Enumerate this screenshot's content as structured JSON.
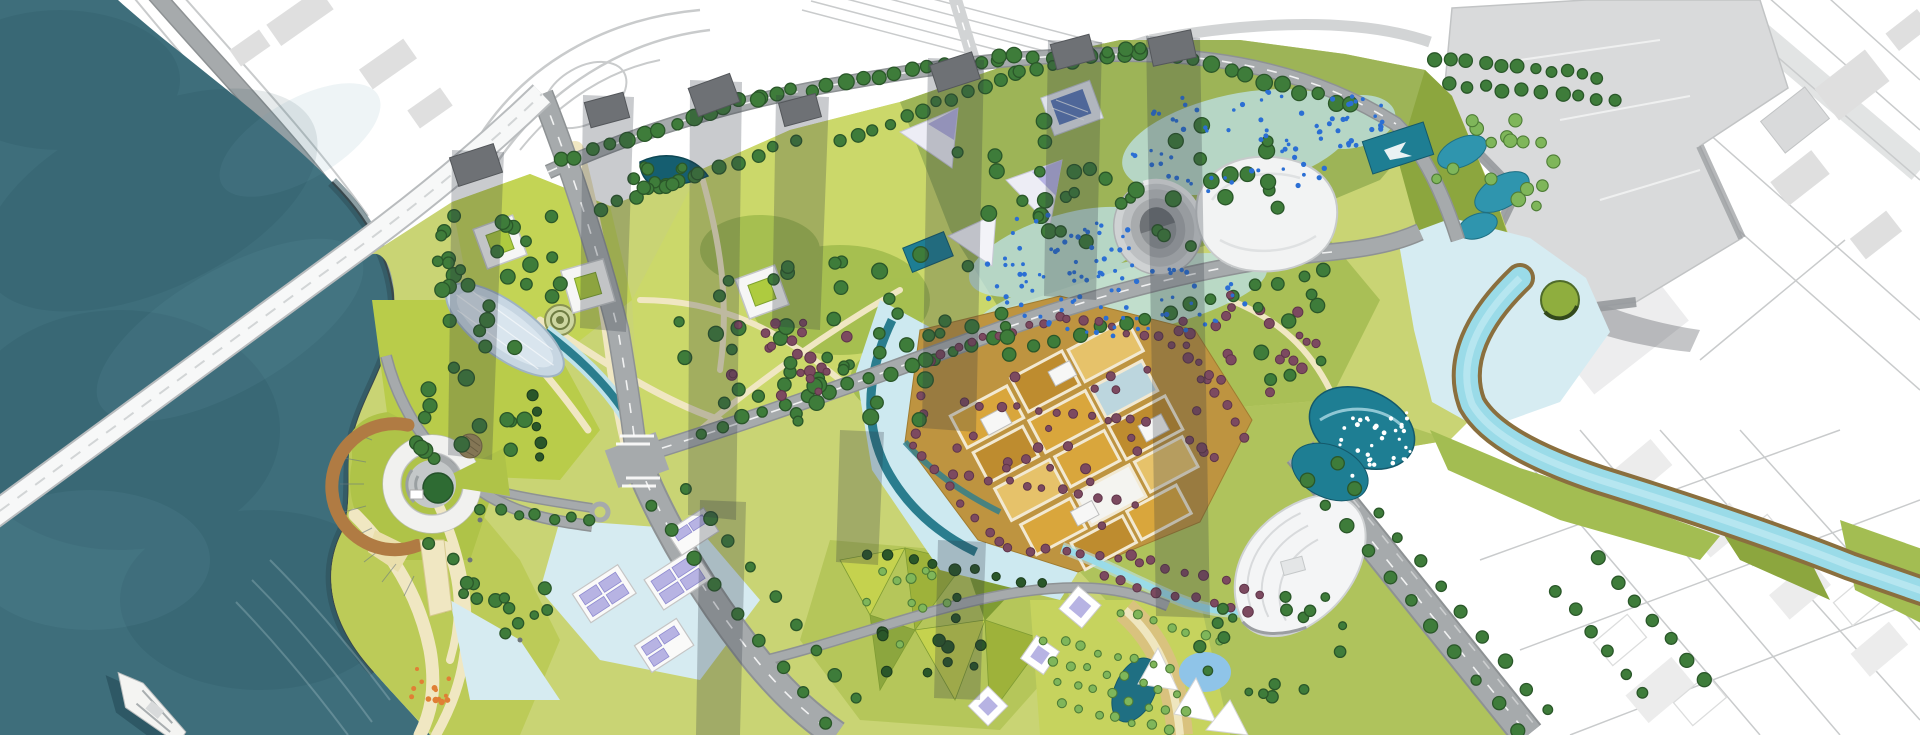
{
  "meta": {
    "title": "aerial-masterplan-rendering",
    "description": "top-down rendered urban waterfront masterplan with teal bay, bridge, parks, golden district, winding river and white line-work city context",
    "canvas": {
      "width": 1920,
      "height": 735
    }
  },
  "palette": {
    "water": "#3E6E7B",
    "waterDeep": "#2E4F58",
    "seawall": "#39484D",
    "contextLine": "#C9CBCC",
    "contextBlob": "#DFDFDF",
    "buildingGray": "#D9DADB",
    "buildingShade": "#96999C",
    "towerGray": "#6E7175",
    "roadGray": "#A6AAAC",
    "roadCase": "#8E9294",
    "bridgeWhite": "#F7F8F8",
    "lawnBright": "#C3D455",
    "lawnMid": "#9DB94A",
    "lawnOlive": "#8CA63E",
    "treeGreen": "#3E7C3A",
    "treeDark": "#2A5729",
    "treeMint": "#7FB65A",
    "maroon": "#7C4A60",
    "maroonDark": "#5F3549",
    "gold": "#D9A63C",
    "goldDark": "#BE8C2F",
    "goldPale": "#E6C26A",
    "lavender": "#B7B3E3",
    "lavenderDark": "#8F8BD0",
    "aqua": "#9ADBE8",
    "aquaPale": "#CDE9F0",
    "tealPond": "#1E7E93",
    "tealDark": "#155E70",
    "sand": "#EADFAC",
    "pathBeige": "#F0E7C2",
    "bankBrown": "#8A6F3E",
    "pierBrown": "#B07B43",
    "orange": "#E07F35",
    "speckBlue": "#2B6FD4",
    "shadowBand": "#2E3540"
  },
  "landmarks": {
    "bay": "tidal-bay-water",
    "bridge": "cable-bridge",
    "boat": "cruise-boat",
    "pier": "circular-ferry-pier",
    "dome": "glasshouse-dome",
    "stadium": "oval-amphitheatre",
    "hall": "exhibition-hall",
    "golden": "golden-courtyard-district",
    "fountains": "twin-fountain-pools",
    "river": "meandering-river-corridor",
    "hq": "headquarters-complex",
    "solar": "solar-roof-buildings",
    "orchard": "orchard-grove",
    "sails": "shade-sail-pavilions",
    "shadows": "tower-shadow-bands"
  },
  "vegetation": {
    "rows": [
      [
        560,
        162,
        758,
        97,
        13,
        7,
        "g"
      ],
      [
        758,
        97,
        998,
        58,
        15,
        7,
        "g"
      ],
      [
        998,
        58,
        1178,
        54,
        11,
        7,
        "g"
      ],
      [
        1178,
        54,
        1352,
        106,
        11,
        7,
        "g"
      ],
      [
        600,
        208,
        795,
        142,
        11,
        6,
        "g"
      ],
      [
        700,
        432,
        995,
        338,
        15,
        6,
        "g"
      ],
      [
        1012,
        352,
        1325,
        270,
        15,
        6,
        "g"
      ],
      [
        726,
        406,
        1000,
        315,
        10,
        6,
        "g"
      ],
      [
        652,
        505,
        826,
        722,
        9,
        6,
        "g"
      ],
      [
        688,
        492,
        858,
        700,
        9,
        6,
        "g"
      ],
      [
        1306,
        478,
        1518,
        728,
        11,
        6,
        "g"
      ],
      [
        1336,
        462,
        1546,
        712,
        11,
        6,
        "g"
      ],
      [
        1558,
        592,
        1642,
        692,
        6,
        6,
        "g"
      ],
      [
        1600,
        560,
        1706,
        682,
        7,
        6,
        "g"
      ],
      [
        482,
        508,
        592,
        522,
        7,
        5,
        "g"
      ],
      [
        533,
        396,
        541,
        458,
        5,
        5,
        "d"
      ],
      [
        1436,
        57,
        1598,
        76,
        11,
        6,
        "g"
      ],
      [
        1448,
        84,
        1618,
        102,
        10,
        6,
        "g"
      ],
      [
        842,
        142,
        1018,
        72,
        12,
        6,
        "g"
      ],
      [
        1020,
        70,
        1140,
        46,
        8,
        6,
        "g"
      ],
      [
        1102,
        576,
        1248,
        614,
        9,
        4.5,
        "m"
      ],
      [
        1130,
        556,
        1262,
        592,
        8,
        4.5,
        "m"
      ],
      [
        942,
        352,
        1058,
        318,
        9,
        4,
        "m"
      ],
      [
        1068,
        316,
        1188,
        346,
        9,
        4,
        "m"
      ],
      [
        1198,
        362,
        1242,
        438,
        6,
        4,
        "m"
      ],
      [
        928,
        362,
        916,
        448,
        6,
        4,
        "m"
      ],
      [
        920,
        458,
        1002,
        544,
        7,
        4,
        "m"
      ],
      [
        1010,
        548,
        1138,
        560,
        8,
        4,
        "m"
      ],
      [
        962,
        402,
        1148,
        422,
        11,
        4,
        "m"
      ],
      [
        952,
        472,
        1118,
        500,
        10,
        4,
        "m"
      ],
      [
        430,
        542,
        520,
        622,
        5,
        6,
        "g"
      ],
      [
        1046,
        638,
        1172,
        670,
        8,
        4,
        "t"
      ],
      [
        1052,
        660,
        1178,
        692,
        8,
        4,
        "t"
      ],
      [
        1058,
        682,
        1184,
        714,
        8,
        4,
        "t"
      ],
      [
        1064,
        704,
        1168,
        732,
        7,
        4,
        "t"
      ],
      [
        1118,
        612,
        1222,
        640,
        7,
        4,
        "t"
      ],
      [
        868,
        552,
        1042,
        584,
        9,
        5,
        "d"
      ]
    ],
    "clusters": [
      [
        508,
        262,
        82,
        62,
        24,
        6.5,
        "g"
      ],
      [
        468,
        392,
        70,
        78,
        20,
        6.5,
        "g"
      ],
      [
        846,
        332,
        168,
        100,
        42,
        6.5,
        "g"
      ],
      [
        792,
        352,
        72,
        44,
        20,
        4.5,
        "m"
      ],
      [
        1118,
        182,
        180,
        75,
        38,
        6.5,
        "g"
      ],
      [
        1246,
        344,
        72,
        52,
        24,
        4.5,
        "m"
      ],
      [
        1258,
        332,
        80,
        56,
        8,
        6,
        "g"
      ],
      [
        1494,
        166,
        62,
        55,
        16,
        6,
        "t"
      ],
      [
        1282,
        640,
        88,
        58,
        18,
        5,
        "g"
      ],
      [
        1086,
        442,
        135,
        85,
        26,
        4,
        "m"
      ],
      [
        948,
        640,
        75,
        55,
        12,
        5,
        "d"
      ],
      [
        516,
        600,
        55,
        45,
        9,
        5.5,
        "g"
      ],
      [
        425,
        688,
        26,
        24,
        13,
        2.6,
        "o"
      ],
      [
        1238,
        142,
        115,
        52,
        55,
        2.2,
        "b"
      ],
      [
        1058,
        252,
        88,
        38,
        44,
        2.2,
        "b"
      ],
      [
        1352,
        122,
        40,
        28,
        26,
        2.2,
        "b"
      ],
      [
        1120,
        300,
        145,
        38,
        55,
        2.2,
        "b"
      ],
      [
        1385,
        448,
        52,
        40,
        40,
        2,
        "w"
      ],
      [
        666,
        178,
        36,
        16,
        12,
        5.5,
        "g"
      ],
      [
        905,
        605,
        60,
        40,
        10,
        4.5,
        "t"
      ]
    ]
  }
}
